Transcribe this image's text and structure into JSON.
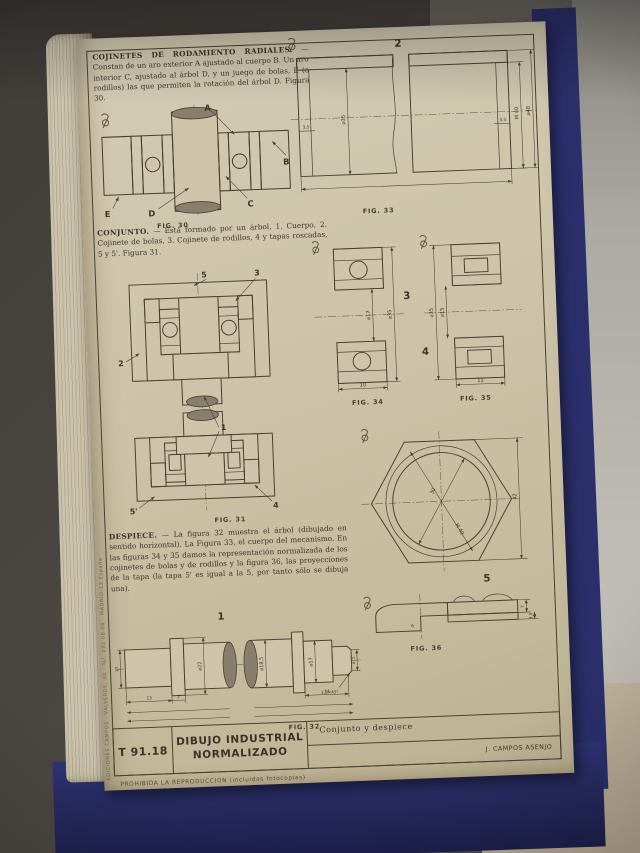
{
  "page": {
    "sections": {
      "cojinetes": {
        "title": "COJINETES DE RODAMIENTO RADIALES.",
        "body": " — Constan de un aro exterior A ajustado al cuerpo B. Un aro interior C, ajustado al árbol D, y un juego de bolas, E (o rodillos) las que permiten la rotación del árbol D. Figura 30."
      },
      "conjunto": {
        "title": "CONJUNTO.",
        "body": " — Está formado por un árbol, 1. Cuerpo, 2. Cojinete de bolas, 3. Cojinete de rodillos, 4 y tapas roscadas, 5 y 5'. Figura 31."
      },
      "despiece": {
        "title": "DESPIECE.",
        "body": " — La figura 32 muestra el árbol (dibujado en sentido horizontal). La Figura 33, el cuerpo del mecanismo. En las figuras 34 y 35 damos la representación normalizada de los cojinetes de bolas y de rodillos y la figura 36, las proyecciones de la tapa (la tapa 5' es igual a la 5, por tanto sólo se dibuja una)."
      }
    },
    "figures": {
      "fig30": {
        "caption": "FIG. 30",
        "labels": {
          "a": "A",
          "b": "B",
          "c": "C",
          "d": "D",
          "e": "E"
        }
      },
      "fig31": {
        "caption": "FIG. 31",
        "labels": {
          "l5": "5",
          "l3": "3",
          "l2": "2",
          "l1": "1",
          "l5p": "5'",
          "l4": "4"
        }
      },
      "fig32": {
        "caption": "FIG. 32",
        "part": "1",
        "dims": {
          "d17": "17",
          "d22": "⌀22",
          "d185": "⌀18,5",
          "d17seat": "⌀17",
          "d15": "⌀15",
          "l13": "13",
          "l2": "2",
          "l14": "14",
          "chamfer": "1,5×45°"
        }
      },
      "fig33": {
        "caption": "FIG. 33",
        "part": "2",
        "dims": {
          "t1": "3,5",
          "bore": "⌀35",
          "t2": "3,5",
          "thread": "M 40",
          "od": "⌀48"
        }
      },
      "fig34": {
        "caption": "FIG. 34",
        "part": "3",
        "dims": {
          "bore": "⌀17",
          "od": "⌀35",
          "w": "10"
        }
      },
      "fig35": {
        "caption": "FIG. 35",
        "part": "4",
        "dims": {
          "od": "⌀35",
          "bore": "⌀15",
          "w": "11"
        }
      },
      "fig36": {
        "caption": "FIG. 36",
        "part": "5",
        "dims": {
          "bore": "30",
          "thread": "M 40",
          "across": "42",
          "h7": "7",
          "h35": "3,5",
          "h6": "6"
        }
      }
    },
    "title_block": {
      "code": "T 91.18",
      "title": "DIBUJO INDUSTRIAL NORMALIZADO",
      "subject": "Conjunto y despiece",
      "author": "J. CAMPOS ASENJO"
    },
    "footer": "PROHIBIDA LA REPRODUCCION (incluidas fotocopias)",
    "spine": "EDICIONES CAMPOS · VALVERDE, 30 · Tel. 232 08 08 · MADRID-13 España"
  }
}
